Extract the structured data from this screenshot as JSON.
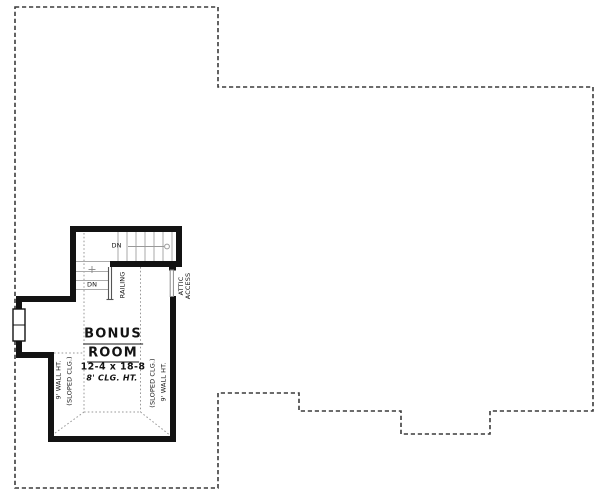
{
  "room": {
    "name_line1": "BONUS",
    "name_line2": "ROOM",
    "dimensions": "12-4 x 18-8",
    "ceiling_height": "8' CLG. HT."
  },
  "labels": {
    "left_wall_height": "9' WALL HT.",
    "left_sloped_ceiling": "(SLOPED CLG.)",
    "right_sloped_ceiling": "(SLOPED CLG.)",
    "right_wall_height": "9' WALL HT.",
    "attic_line1": "ATTIC",
    "attic_line2": "ACCESS",
    "railing": "RAILING",
    "down_upper": "DN",
    "down_lower": "DN"
  },
  "colors": {
    "background": "#ffffff",
    "wall": "#131313",
    "roof_outline_dash": "#3c3c3c",
    "ceiling_break_dotted": "#999999",
    "stair_tread": "#aaaaaa",
    "railing_line": "#555555",
    "text": "#131313"
  }
}
